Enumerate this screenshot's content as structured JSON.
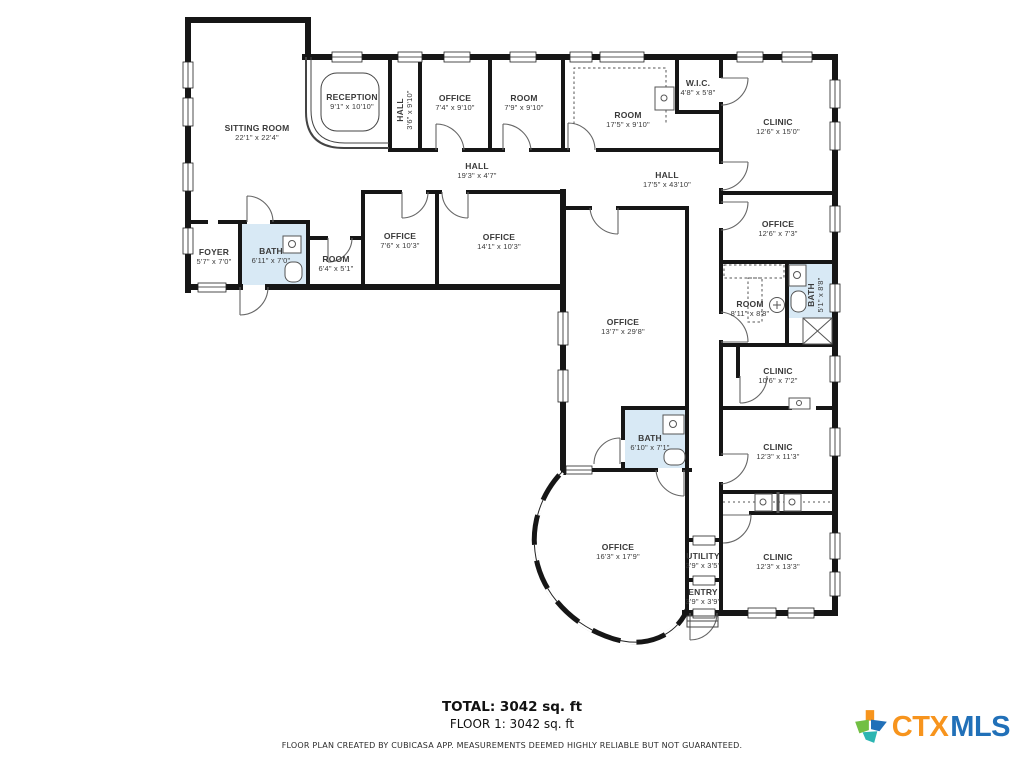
{
  "colors": {
    "wall": "#161616",
    "bath_fill": "#D8E9F5",
    "label": "#3A3A3A",
    "logo_orange": "#F7941D",
    "logo_blue": "#2170B8",
    "logo_green": "#72BF44",
    "logo_teal": "#2CB5B2"
  },
  "plan": {
    "rooms": [
      {
        "name": "SITTING ROOM",
        "dims": "22'1\" x 22'4\""
      },
      {
        "name": "RECEPTION",
        "dims": "9'1\" x 10'10\""
      },
      {
        "name": "HALL",
        "dims": "3'6\" x 9'10\""
      },
      {
        "name": "OFFICE",
        "dims": "7'4\" x 9'10\""
      },
      {
        "name": "ROOM",
        "dims": "7'9\" x 9'10\""
      },
      {
        "name": "ROOM",
        "dims": "17'5\" x 9'10\""
      },
      {
        "name": "W.I.C.",
        "dims": "4'8\" x 5'8\""
      },
      {
        "name": "CLINIC",
        "dims": "12'6\" x 15'0\""
      },
      {
        "name": "HALL",
        "dims": "19'3\" x 4'7\""
      },
      {
        "name": "HALL",
        "dims": "17'5\" x 43'10\""
      },
      {
        "name": "FOYER",
        "dims": "5'7\" x 7'0\""
      },
      {
        "name": "BATH",
        "dims": "6'11\" x 7'0\""
      },
      {
        "name": "ROOM",
        "dims": "6'4\" x 5'1\""
      },
      {
        "name": "OFFICE",
        "dims": "7'6\" x 10'3\""
      },
      {
        "name": "OFFICE",
        "dims": "14'1\" x 10'3\""
      },
      {
        "name": "OFFICE",
        "dims": "12'6\" x 7'3\""
      },
      {
        "name": "ROOM",
        "dims": "8'11\" x 8'8\""
      },
      {
        "name": "BATH",
        "dims": "5'1\" x 8'8\""
      },
      {
        "name": "OFFICE",
        "dims": "13'7\" x 29'8\""
      },
      {
        "name": "CLINIC",
        "dims": "10'6\" x 7'2\""
      },
      {
        "name": "BATH",
        "dims": "6'10\" x 7'1\""
      },
      {
        "name": "CLINIC",
        "dims": "12'3\" x 11'3\""
      },
      {
        "name": "OFFICE",
        "dims": "16'3\" x 17'9\""
      },
      {
        "name": "UTILITY",
        "dims": "3'9\" x 3'5\""
      },
      {
        "name": "ENTRY",
        "dims": "3'9\" x 3'9\""
      },
      {
        "name": "CLINIC",
        "dims": "12'3\" x 13'3\""
      }
    ]
  },
  "summary": {
    "total": "TOTAL: 3042 sq. ft",
    "floor": "FLOOR 1: 3042 sq. ft"
  },
  "disclaimer": "FLOOR PLAN CREATED BY CUBICASA APP. MEASUREMENTS DEEMED HIGHLY RELIABLE BUT NOT GUARANTEED.",
  "logo": {
    "ctx": "CTX",
    "mls": "MLS"
  }
}
